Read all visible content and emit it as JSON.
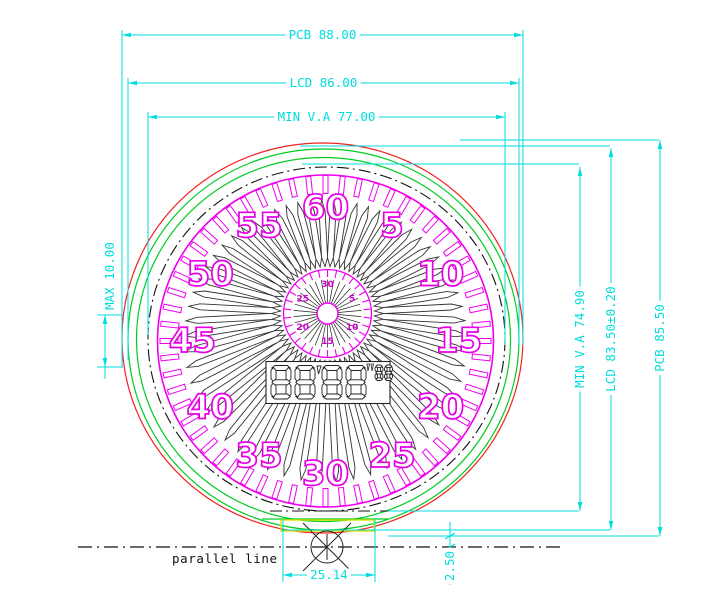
{
  "drawing": {
    "colors": {
      "dimension": "#00dede",
      "dial": "#f000f0",
      "dial_number": "#e800e8",
      "inner_number": "#cf00cf",
      "pcb_outline": "#f22222",
      "lcd_outline": "#00cc22",
      "viewing_area": "#111111",
      "tab_outline": "#e0e000",
      "ink": "#222222"
    },
    "dimensions": {
      "horizontal": [
        {
          "id": "pcb-width",
          "label": "PCB 88.00"
        },
        {
          "id": "lcd-width",
          "label": "LCD 86.00"
        },
        {
          "id": "min-va-width",
          "label": "MIN V.A 77.00"
        },
        {
          "id": "tab-width",
          "label": "25.14"
        }
      ],
      "vertical": [
        {
          "id": "min-va-height",
          "label": "MIN V.A 74.90"
        },
        {
          "id": "lcd-height",
          "label": "LCD 83.50±0.20"
        },
        {
          "id": "pcb-height",
          "label": "PCB 85.50"
        },
        {
          "id": "max-offset",
          "label": "MAX 10.00"
        },
        {
          "id": "pcb-edge-to-parallel-line",
          "label": "2.50"
        }
      ]
    },
    "annotations": {
      "parallel_line": "parallel line"
    },
    "outer_dial": {
      "numbers": [
        60,
        5,
        10,
        15,
        20,
        25,
        30,
        35,
        40,
        45,
        50,
        55
      ],
      "tick_count": 60,
      "petal_count": 60
    },
    "inner_dial": {
      "numbers": [
        30,
        5,
        10,
        15,
        20,
        25
      ],
      "tick_count": 30
    },
    "display": {
      "large_digits": "8888",
      "minutes_mark": "'",
      "seconds_mark": "\"",
      "small_digits": "88"
    }
  }
}
